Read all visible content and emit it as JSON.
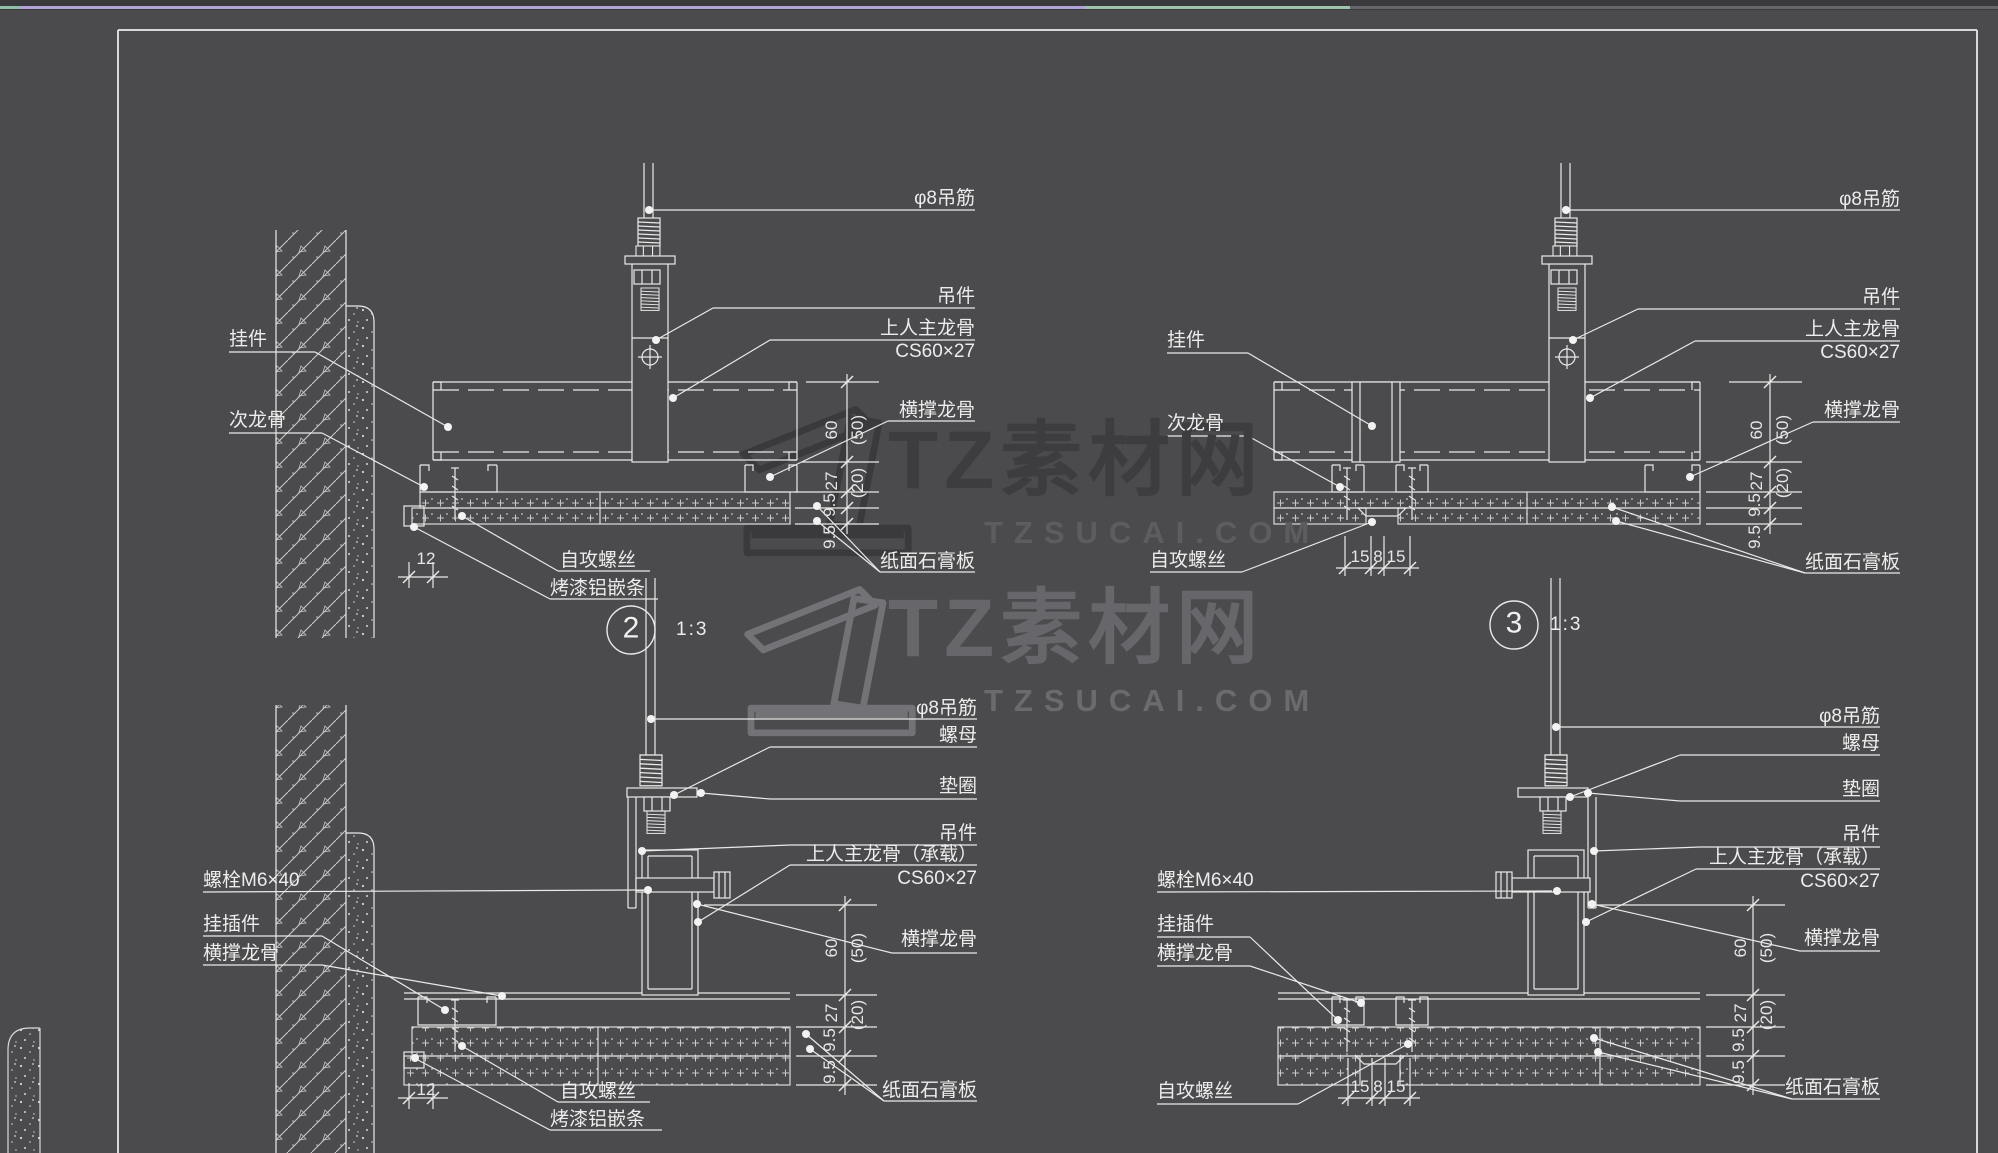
{
  "watermark": {
    "brand": "TZ素材网",
    "site": "TZSUCAI.COM"
  },
  "terms": {
    "hanger_rod": "φ8吊筋",
    "hanger": "吊件",
    "main_keel": "上人主龙骨",
    "main_keel_load": "上人主龙骨（承载）",
    "keel_spec": "CS60×27",
    "cross_keel": "横撑龙骨",
    "sub_keel": "次龙骨",
    "hook": "挂件",
    "hook_insert": "挂插件",
    "gypsum_board": "纸面石膏板",
    "self_screw": "自攻螺丝",
    "alu_strip": "烤漆铝嵌条",
    "bolt": "螺栓M6×40",
    "nut": "螺母",
    "washer": "垫圈"
  },
  "dims": {
    "keel_h": "60",
    "keel_h_alt": "(50)",
    "sub_h": "27",
    "sub_h_alt": "(20)",
    "board": "9.5",
    "edge": "12",
    "strip_side": "15",
    "strip_mid": "8"
  },
  "badges": {
    "d2": {
      "num": "2",
      "scale": "1:3"
    },
    "d3": {
      "num": "3",
      "scale": "1:3"
    }
  }
}
